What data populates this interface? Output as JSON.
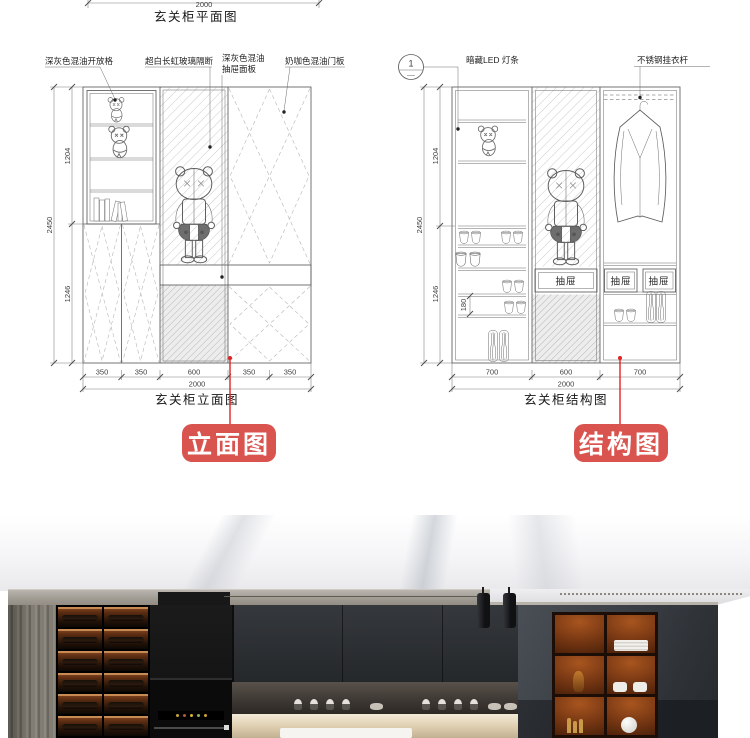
{
  "plan": {
    "dim_width": "2000",
    "caption": "玄关柜平面图"
  },
  "elevation": {
    "caption": "玄关柜立面图",
    "tag": "立面图",
    "callout_open_grid": "深灰色混油开放格",
    "callout_glass": "超白长虹玻璃隔断",
    "callout_drawer_line1": "深灰色混油",
    "callout_drawer_line2": "抽屉面板",
    "callout_door": "奶咖色混油门板",
    "dim_height_total": "2450",
    "dim_height_upper": "1204",
    "dim_height_lower": "1246",
    "dim_widths": [
      "350",
      "350",
      "600",
      "350",
      "350"
    ],
    "dim_width_total": "2000"
  },
  "structure": {
    "caption": "玄关柜结构图",
    "tag": "结构图",
    "section_no": "1",
    "callout_led": "暗藏LED 灯条",
    "callout_rod": "不锈钢挂衣杆",
    "drawer_labels": [
      "抽屉",
      "抽屉",
      "抽屉"
    ],
    "dim_height_total": "2450",
    "dim_height_upper": "1204",
    "dim_height_lower": "1246",
    "dim_shelf": "180",
    "dim_widths": [
      "700",
      "600",
      "700"
    ],
    "dim_width_total": "2000"
  },
  "colors": {
    "tag_red": "#d9534f",
    "leader_red": "#e02525"
  }
}
